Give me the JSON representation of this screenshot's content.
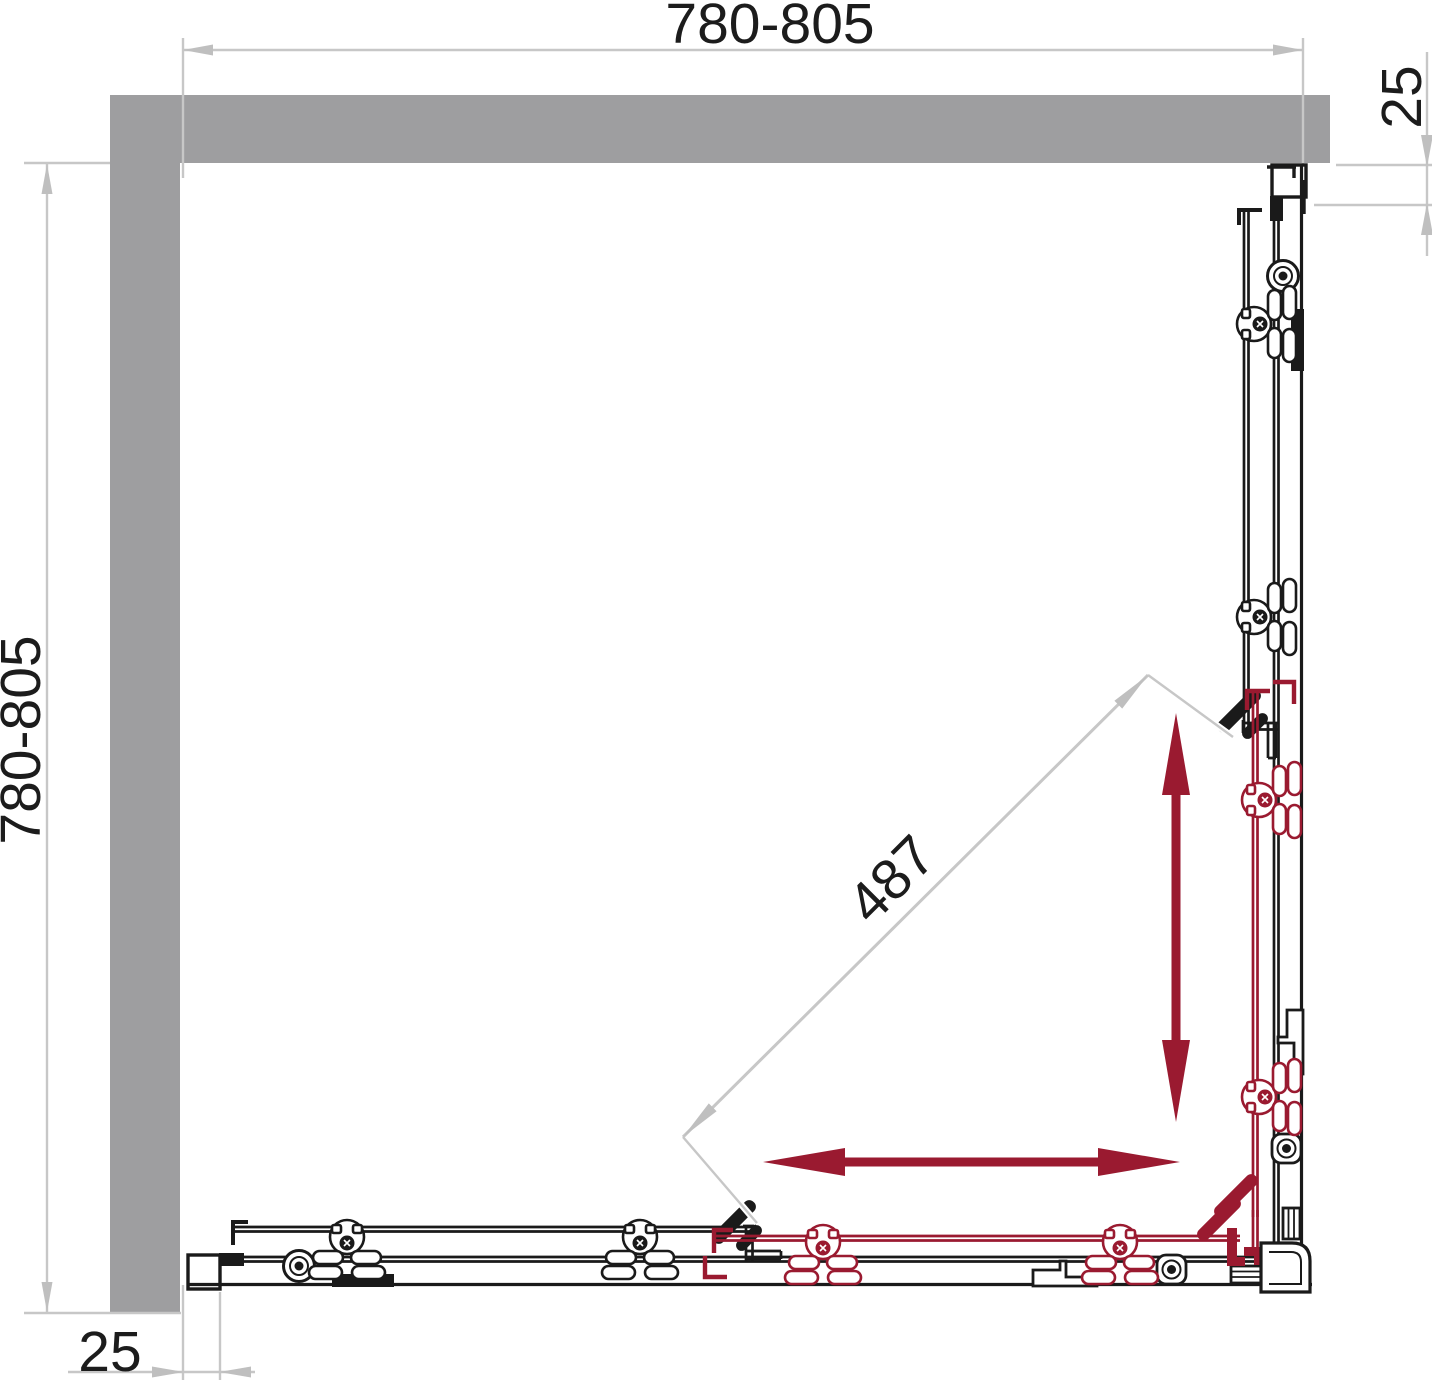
{
  "drawing": {
    "title": "shower-enclosure-plan",
    "labels": {
      "width_range": "780-805",
      "depth_range": "780-805",
      "top_right_offset": "25",
      "bottom_left_offset": "25",
      "diagonal_clearance": "487"
    },
    "colors": {
      "wall_gray": "#9e9ea0",
      "dimension_gray": "#c7c7c7",
      "arrow_gray": "#bfbfbf",
      "line_black": "#1a1a1a",
      "door_accent_red": "#9a1a30",
      "text": "#1c1c1c",
      "background": "#ffffff"
    }
  }
}
